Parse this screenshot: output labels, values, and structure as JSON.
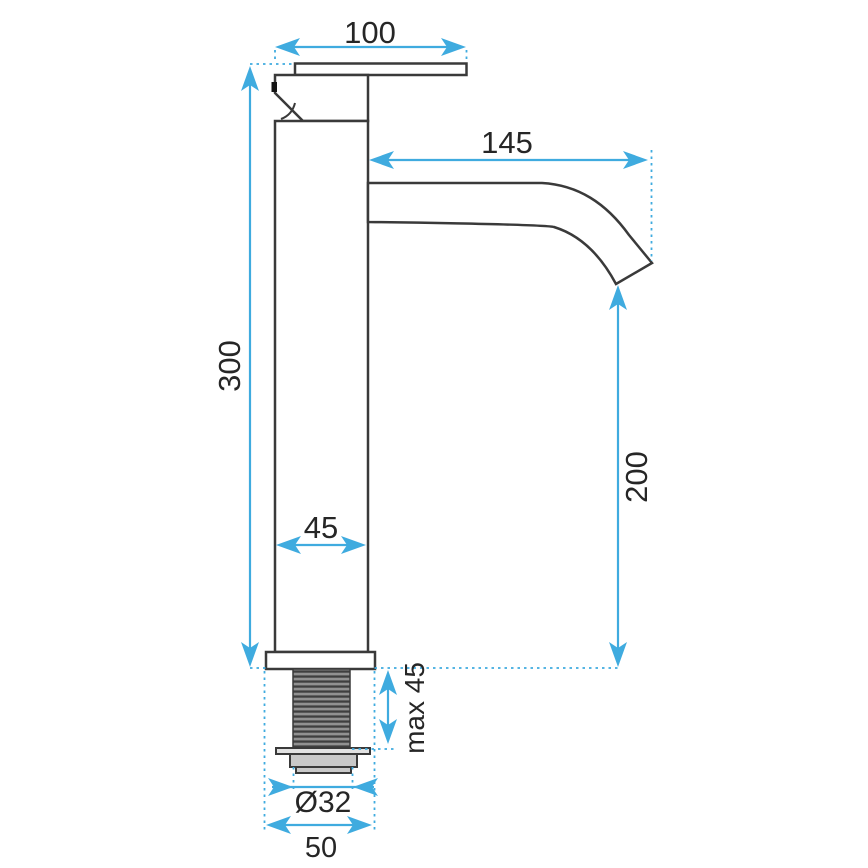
{
  "colors": {
    "accent": "#3fabdf",
    "ink": "#262626",
    "outline": "#3a3a3a",
    "metal": "#c9c9c9",
    "flange": "#e2e2e2",
    "bg": "#ffffff"
  },
  "dimensions": {
    "handle_length": {
      "label": "100"
    },
    "spout_reach": {
      "label": "145"
    },
    "total_height": {
      "label": "300"
    },
    "body_width": {
      "label": "45"
    },
    "outlet_height": {
      "label": "200"
    },
    "max_mount_thickness": {
      "label": "max 45"
    },
    "thread_diameter": {
      "label": "Ø32"
    },
    "base_width": {
      "label": "50"
    }
  }
}
